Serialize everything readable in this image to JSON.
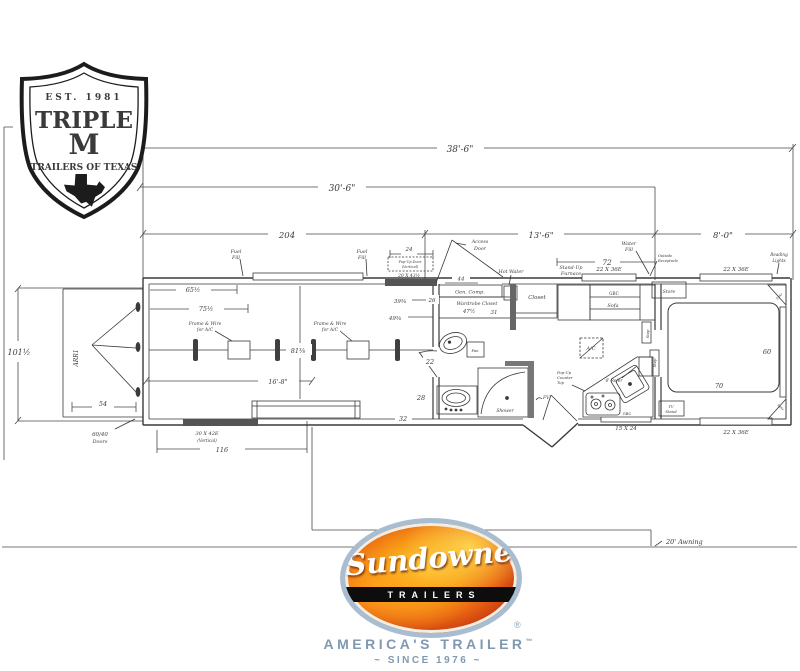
{
  "brand_top": {
    "est": "EST. 1981",
    "name_line1": "TRIPLE",
    "name_line2": "M",
    "name_line3": "TRAILERS OF TEXAS"
  },
  "brand_bottom": {
    "script": "Sundowner",
    "band": "TRAILERS",
    "registered": "®",
    "tagline": "AMERICA'S TRAILER",
    "trademark": "™",
    "since": "~ SINCE 1976 ~"
  },
  "dims": {
    "overall_length": "38'-6\"",
    "box_length": "30'-6\"",
    "horse_area_in": "204",
    "lq_length": "13'-6\"",
    "neck_length": "8'-0\"",
    "width": "101½",
    "d65": "65½",
    "d75": "75½",
    "d81": "81⅜",
    "d24": "24",
    "d39": "39⅜",
    "d49": "49⅜",
    "d44": "44",
    "d26": "26",
    "d47": "47½",
    "d31": "31",
    "d72": "72",
    "d16_8": "16'-8\"",
    "d54": "54",
    "d116": "116",
    "d22": "22",
    "d28": "28",
    "d32": "32",
    "bed_width": "70",
    "bed_length": "60"
  },
  "labels": {
    "fuel_fill": [
      "Fuel",
      "Fill"
    ],
    "water_fill": [
      "Water",
      "Fill"
    ],
    "popup_door": [
      "Pop-Up Door",
      "(Vertical)",
      "20 X 43½"
    ],
    "access_door": [
      "Access",
      "Door"
    ],
    "gen_comp": "Gen. Comp.",
    "wardrobe_closet": "Wardrobe Closet",
    "closet": "Closet",
    "hot_water": "Hot Water",
    "standup_furnace": [
      "Stand-Up",
      "Furnace"
    ],
    "outside_receptacle": [
      "Outside",
      "Receptacle"
    ],
    "reading_lights": [
      "Reading",
      "Lights"
    ],
    "window_22x36": "22 X 36E",
    "window_15x24": "15 X 24",
    "store": "Store",
    "gbc": "GBC",
    "sofa": "Sofa",
    "step": "Step",
    "spkr": "Spkr",
    "ac": "A/C",
    "fan": "Fan",
    "frame_wire_ac": [
      "Frame & Wire",
      "for A/C"
    ],
    "shower": "Shower",
    "fv": "FV",
    "popup_counter": [
      "Pop-Up",
      "Counter",
      "Top"
    ],
    "refer": "6' Refer",
    "tv_stand": [
      "TV",
      "Stand"
    ],
    "arr1": "ARR1",
    "doors_60_40": [
      "60/40",
      "Doors"
    ],
    "door_30x42": [
      "30 X 42E",
      "(Vertical)"
    ],
    "awning": "20' Awning"
  }
}
